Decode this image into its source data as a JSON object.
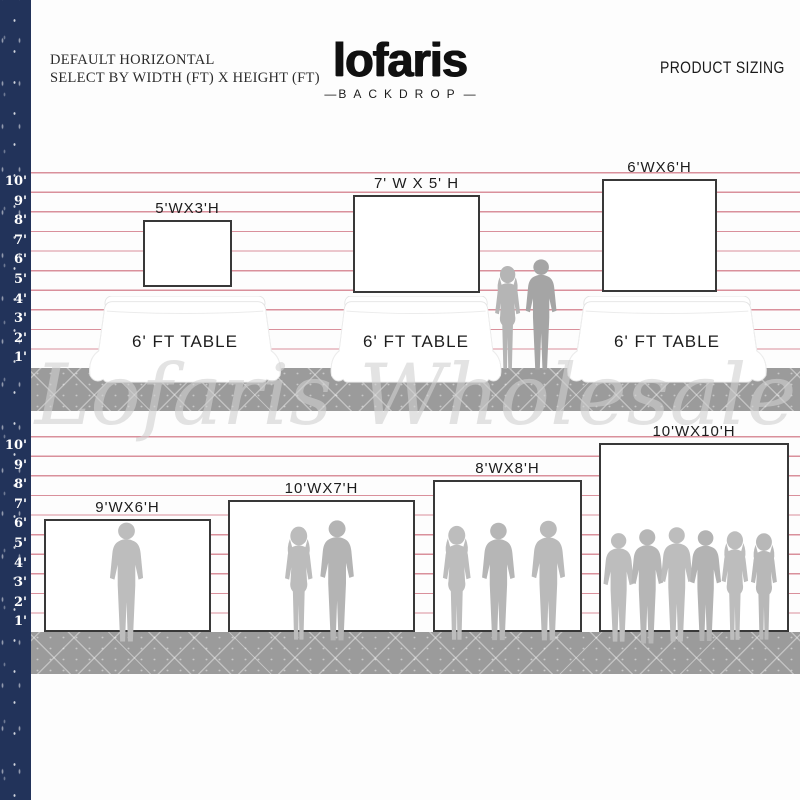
{
  "header": {
    "left_line1": "DEFAULT HORIZONTAL",
    "left_line2": "SELECT BY WIDTH (FT) X HEIGHT (FT)",
    "logo": "lofaris",
    "logo_dash": "—",
    "logo_sub": "BACKDROP",
    "right": "PRODUCT SIZING"
  },
  "watermark": "Lofaris Wholesale",
  "ruler_labels": [
    "10'",
    "9'",
    "8'",
    "7'",
    "6'",
    "5'",
    "4'",
    "3'",
    "2'",
    "1'"
  ],
  "table_label": "6' FT TABLE",
  "backdrops_top": [
    {
      "label": "5'WX3'H"
    },
    {
      "label": "7' W X 5' H"
    },
    {
      "label": "6'WX6'H"
    }
  ],
  "backdrops_bottom": [
    {
      "label": "9'WX6'H"
    },
    {
      "label": "10'WX7'H"
    },
    {
      "label": "8'WX8'H"
    },
    {
      "label": "10'WX10'H"
    }
  ],
  "colors": {
    "navy": "#22335a",
    "line_red": "#d9909b",
    "band_gray": "#9b9b9b",
    "silhouette_gray": "#b8b8b8",
    "backdrop_border": "#383838"
  }
}
